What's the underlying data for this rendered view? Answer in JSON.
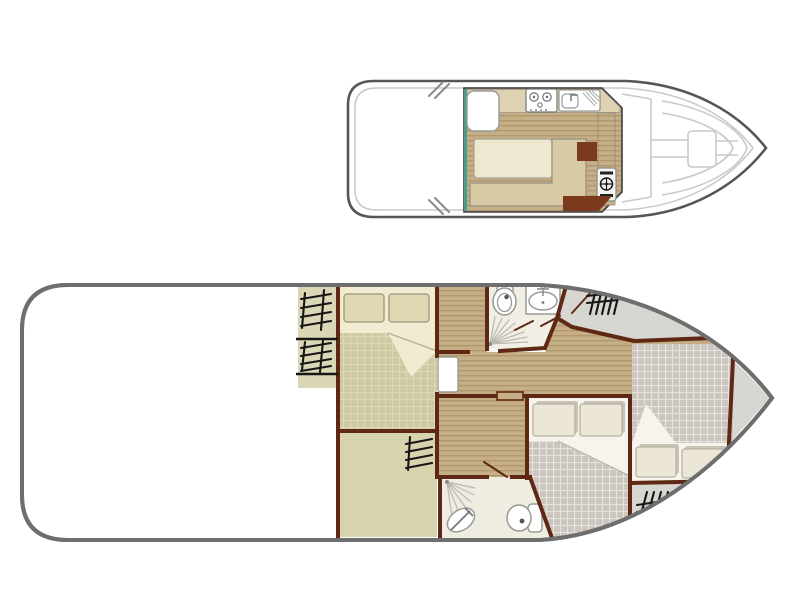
{
  "app": {
    "type": "boat-deck-floor-plan",
    "views": [
      "upper-deck",
      "lower-deck"
    ]
  },
  "colors": {
    "wall": "#5E2815",
    "hull": "#6E6E6E",
    "hulltop": "#565656",
    "innerline": "#C8C8C8",
    "deckline": "#C9C9C9",
    "plank": "#C5AF86",
    "plankline": "#B1986F",
    "khakibed": "#CEC8A3",
    "khakigrid": "#DDD8B8",
    "cream": "#F1EBD1",
    "pillowkhaki": "#DFD7B2",
    "pillowedge": "#A9A186",
    "graybed": "#CCC5BF",
    "graygrid": "#E7E3DD",
    "sheet": "#F6F4ED",
    "pillowwhite": "#ECE6D6",
    "pillowshadow": "#C7C2B4",
    "beige": "#DBD6B5",
    "aftfloor": "#D8D3AF",
    "bathfloor": "#F0EEE5",
    "bath2floor": "#EFEDE2",
    "graydeck": "#D7D6D1",
    "counter": "#DFD2B2",
    "table": "#EFE8D0",
    "bench": "#D8CAA4",
    "brown": "#7B3A1E",
    "teal": "#4A9E8E",
    "hatch": "#161616",
    "fixline": "#9A9A94",
    "sprayline": "#B9B9B0",
    "doorwhite": "#FFFFFF"
  },
  "upper_deck": {
    "features": [
      "aft-sundeck",
      "saloon-plank-floor",
      "galley-counter",
      "stove-icon",
      "sink-with-drainer-icon",
      "fridge-unit",
      "dinette-table",
      "l-shaped-bench",
      "helm-console",
      "steering-wheel-icon",
      "windshield",
      "foredeck-walkway",
      "bow-hatch",
      "mooring-cleats"
    ]
  },
  "lower_deck": {
    "features": [
      "aft-open-deck",
      "companionway-steps",
      "aft-cabin-double-bed",
      "fore-bathroom-toilet-sink-shower",
      "aft-bathroom-toilet-sink-shower",
      "central-corridor",
      "mid-cabin-double-bed",
      "bow-cabin-double-bed",
      "deck-ladder-hatches",
      "cabin-door"
    ]
  }
}
